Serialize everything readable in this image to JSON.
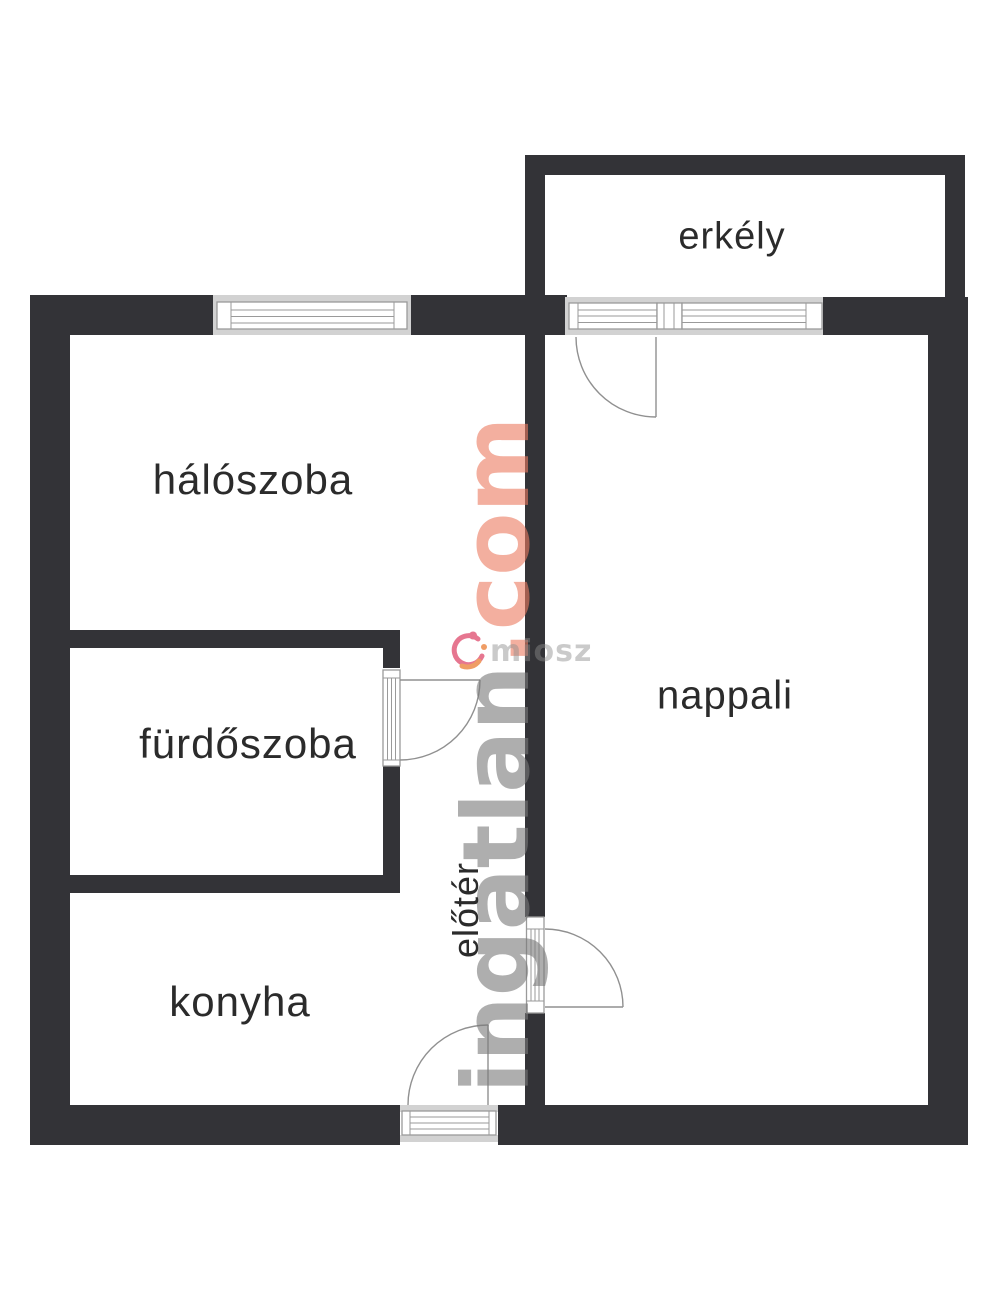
{
  "rooms": {
    "erkely": "erkély",
    "haloszoba": "hálószoba",
    "furdoszoba": "fürdőszoba",
    "nappali": "nappali",
    "eloter": "előtér",
    "konyha": "konyha"
  },
  "watermark": {
    "name": "ingatlan",
    "tld": ".com",
    "partner": "miosz"
  },
  "colors": {
    "wall": "#333337",
    "opening-band": "#d2d2d2",
    "frame-line": "#9a9a9a",
    "door-line": "#909090",
    "label": "#2b2b2b",
    "wm-gray": "#7a7a7a",
    "wm-salmon": "#ec7b61",
    "partner-text": "#8c8c8c",
    "logo-pink": "#e25f7d",
    "logo-orange": "#ed8c4b"
  }
}
